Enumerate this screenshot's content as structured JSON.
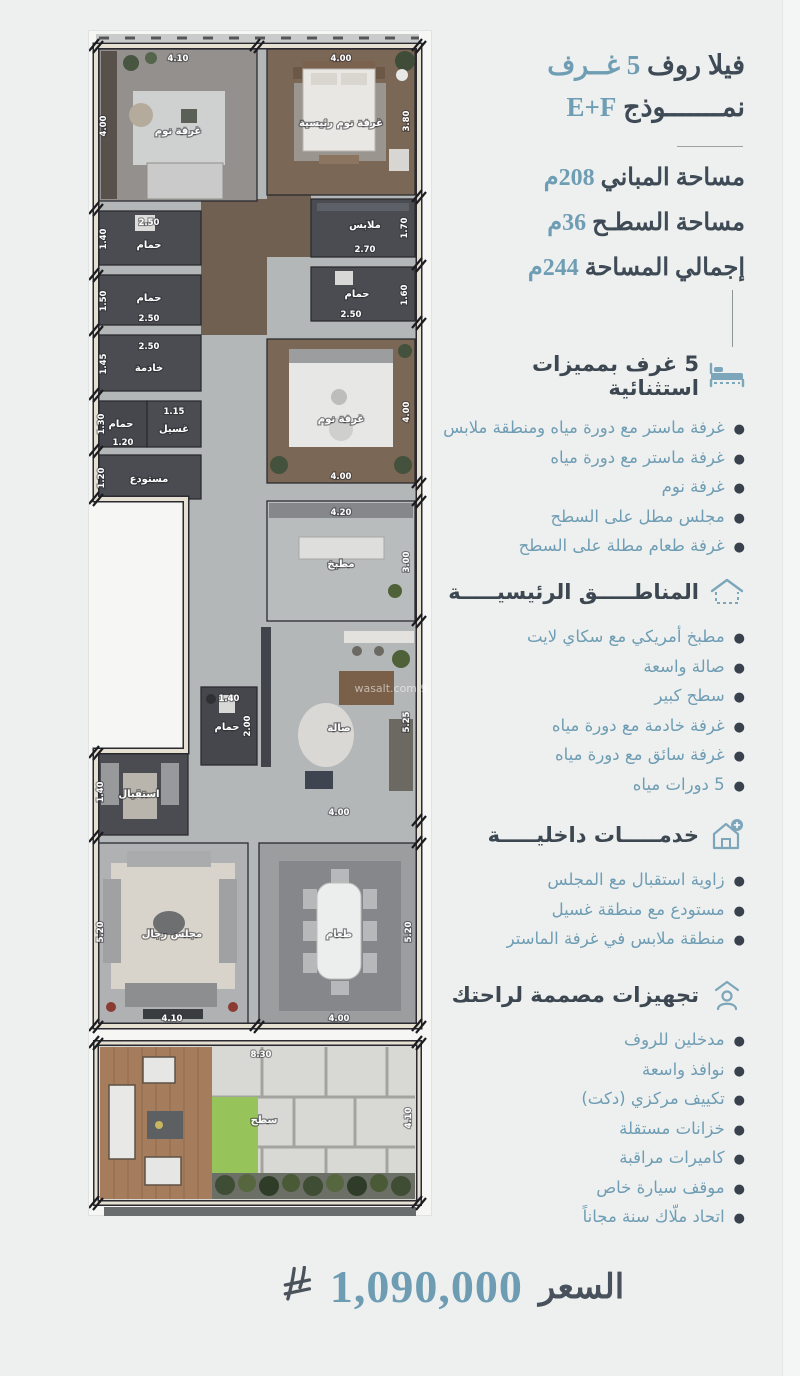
{
  "colors": {
    "accent": "#6f9db4",
    "dark_text": "#3e4a55",
    "background": "#edf0ef",
    "price_blue": "#6e9cb3"
  },
  "header": {
    "title_line1_dark": "فيلا روف",
    "title_line1_accent": "5 غــرف",
    "title_line2_dark": "نمـــــــوذج",
    "title_line2_accent": "E+F",
    "stats": [
      {
        "label": "مساحة المباني",
        "value": "208م"
      },
      {
        "label": "مساحة السطـح",
        "value": "36م"
      },
      {
        "label": "إجمالي المساحة",
        "value": "244م"
      }
    ]
  },
  "sections": [
    {
      "icon": "bed-icon",
      "title": "5 غرف بمميزات استثنائية",
      "items": [
        "غرفة ماستر مع دورة مياه ومنطقة ملابس",
        "غرفة ماستر مع دورة مياه",
        "غرفة نوم",
        "مجلس مطل على السطح",
        "غرفة طعام مطلة على السطح"
      ]
    },
    {
      "icon": "house-icon",
      "title": "المناطـــــق الرئيسيـــــة",
      "items": [
        "مطبخ أمريكي مع سكاي لايت",
        "صالة واسعة",
        "سطح كبير",
        "غرفة خادمة مع دورة مياه",
        "غرفة سائق مع دورة مياه",
        "5 دورات مياه"
      ]
    },
    {
      "icon": "house-plus-icon",
      "title": "خدمـــــات داخليـــــة",
      "items": [
        "زاوية استقبال مع المجلس",
        "مستودع مع منطقة غسيل",
        "منطقة ملابس في غرفة الماستر"
      ]
    },
    {
      "icon": "person-home-icon",
      "title": "تجهيزات مصممة لراحتك",
      "items": [
        "مدخلين للروف",
        "نوافذ واسعة",
        "تكييف مركزي (دكت)",
        "خزانات مستقلة",
        "كاميرات مراقبة",
        "موقف سيارة خاص",
        "اتحاد ملّاك سنة مجاناً"
      ]
    }
  ],
  "plan": {
    "watermark": "wasalt.com 9",
    "rooms": {
      "bedroom1": {
        "label": "غرفة نوم",
        "dim_top": "4.10",
        "dim_left": "4.00"
      },
      "master": {
        "label": "غرفة نوم رئيسية",
        "dim_top": "4.00",
        "dim_right": "3.80"
      },
      "closet": {
        "label": "ملابس",
        "dim_right": "1.70",
        "dim_bottom": "2.70"
      },
      "bath_a": {
        "label": "حمام",
        "dim_top": "2.50",
        "dim_left": "1.40"
      },
      "bath_b": {
        "label": "حمام",
        "dim_left": "1.50",
        "dim_bottom": "2.50"
      },
      "bath_c": {
        "label": "حمام",
        "dim_bottom": "2.50",
        "dim_right": "1.60"
      },
      "maid": {
        "label": "خادمة",
        "dim_top": "2.50",
        "dim_left": "1.45"
      },
      "laundry": {
        "label": "غسيل",
        "dim_top": "1.15"
      },
      "bath_d": {
        "label": "حمام",
        "dim_left": "1.30",
        "dim_bottom": "1.20"
      },
      "storage": {
        "label": "مستودع",
        "dim_left": "1.20"
      },
      "bedroom2": {
        "label": "غرفة نوم",
        "dim_bottom": "4.00",
        "dim_right": "4.00"
      },
      "kitchen": {
        "label": "مطبخ",
        "dim_top": "4.20",
        "dim_right": "3.00"
      },
      "bath_e": {
        "label": "حمام",
        "dim_top": "1.40",
        "dim_right": "2.00"
      },
      "hall": {
        "label": "صالة",
        "dim_bottom": "4.00",
        "dim_right": "5.25"
      },
      "reception": {
        "label": "استقبال",
        "dim_left": "1.40"
      },
      "majlis": {
        "label": "مجلس رجال",
        "dim_bottom": "4.10",
        "dim_left": "5.20"
      },
      "dining": {
        "label": "طعام",
        "dim_bottom": "4.00",
        "dim_right": "5.20"
      },
      "roof": {
        "label": "سطح",
        "dim_top": "8.30",
        "dim_right": "4.10"
      }
    }
  },
  "price": {
    "label": "السعر",
    "value": "1,090,000",
    "currency_icon": "saudi-riyal-symbol"
  }
}
